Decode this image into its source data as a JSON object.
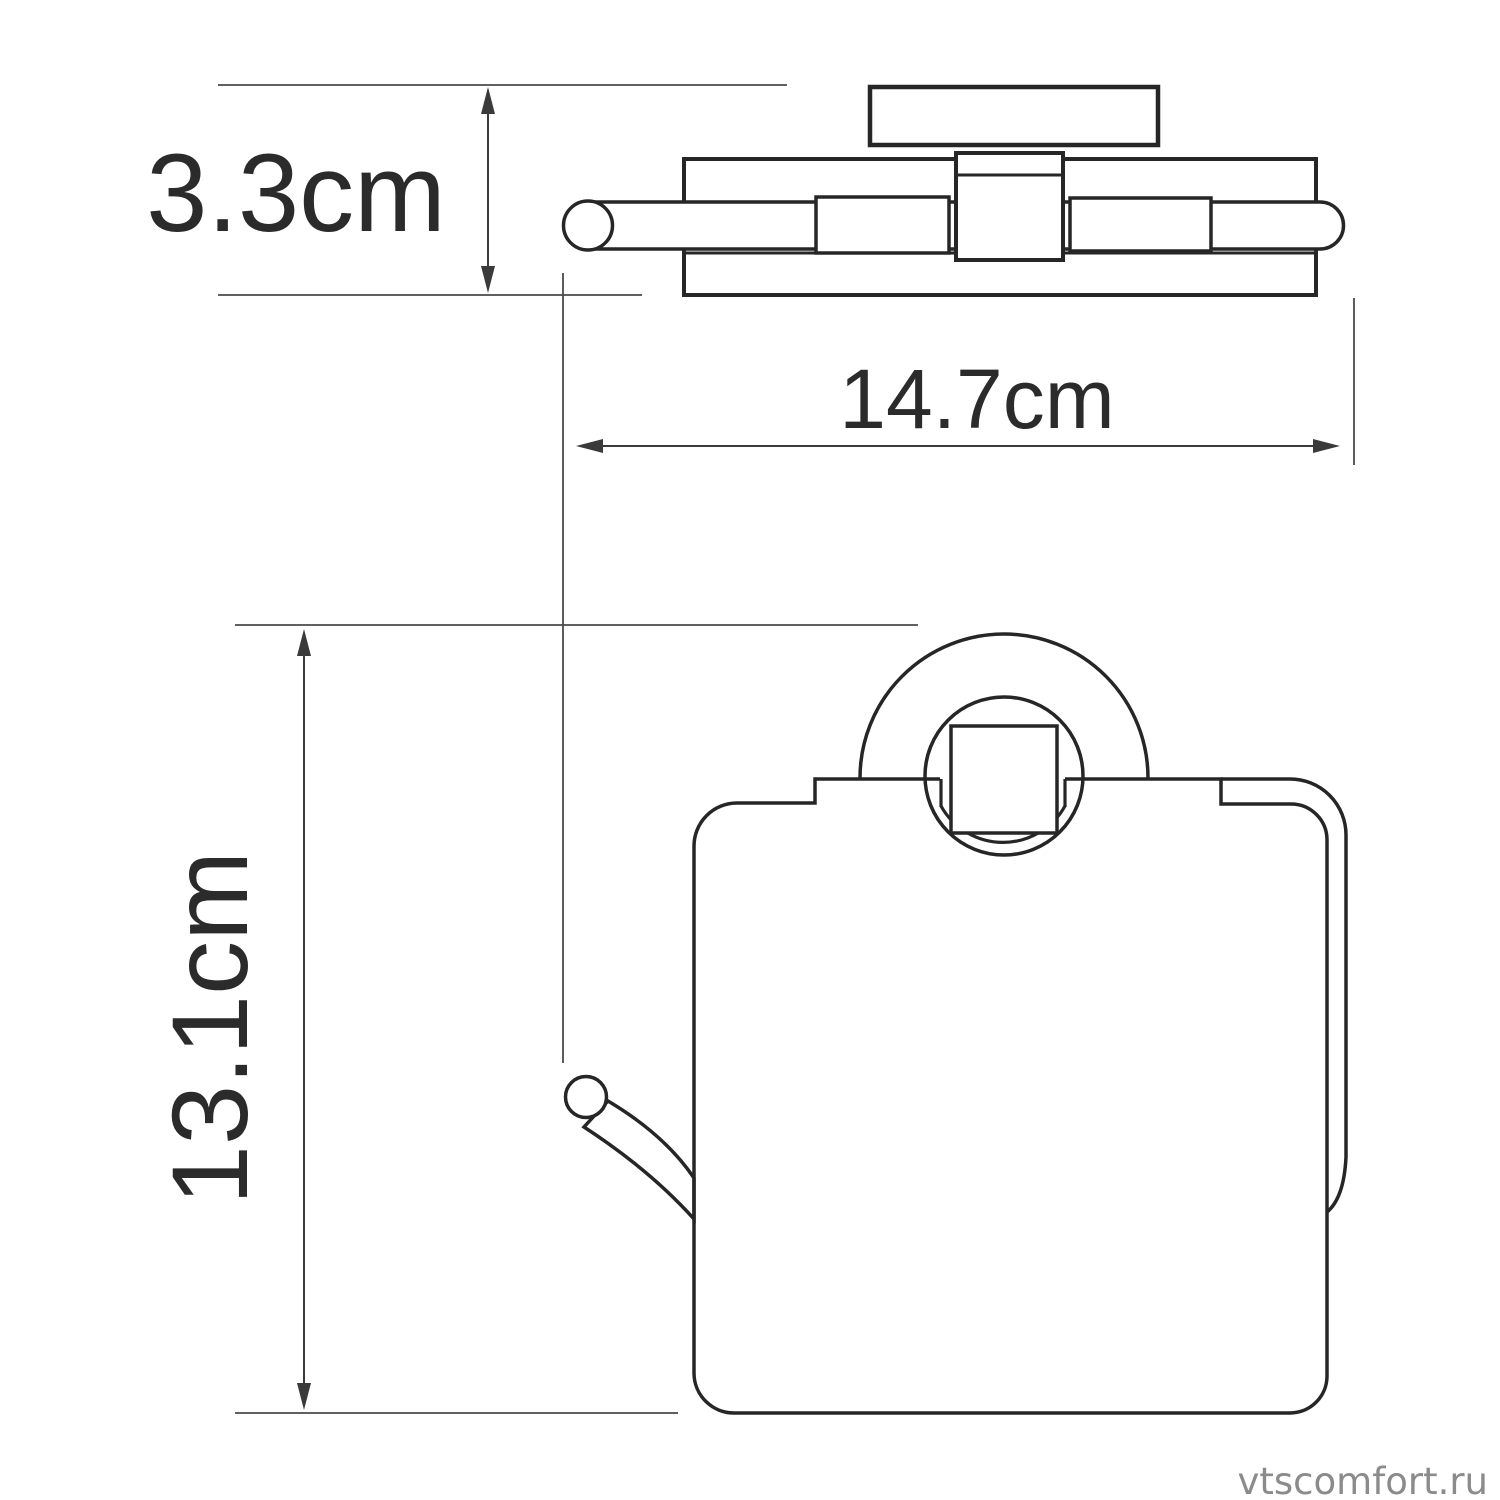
{
  "diagram": {
    "type": "technical-dimension-drawing",
    "subject": "wall-mounted covered toilet paper holder, top view and front view",
    "views": [
      {
        "id": "top-view",
        "description": "top (plan) view of holder with wall plate, roll bar and center bracket"
      },
      {
        "id": "front-view",
        "description": "front view of holder with cover, mounting ring and spare-roll hook"
      }
    ],
    "dimensions": [
      {
        "id": "depth-top-view",
        "label": "3.3cm",
        "value_cm": 3.3,
        "orientation": "vertical",
        "view": "top-view"
      },
      {
        "id": "overall-width",
        "label": "14.7cm",
        "value_cm": 14.7,
        "orientation": "horizontal",
        "view": "front-view"
      },
      {
        "id": "overall-height",
        "label": "13.1cm",
        "value_cm": 13.1,
        "orientation": "vertical",
        "view": "front-view"
      }
    ],
    "watermark": "vtscomfort.ru",
    "colors": {
      "background": "#ffffff",
      "outline": "#262626",
      "dimension_line": "#3a3a3a",
      "extension_line": "#4a4a4a",
      "text": "#2b2b2b",
      "watermark": "#8b8b8b"
    }
  }
}
